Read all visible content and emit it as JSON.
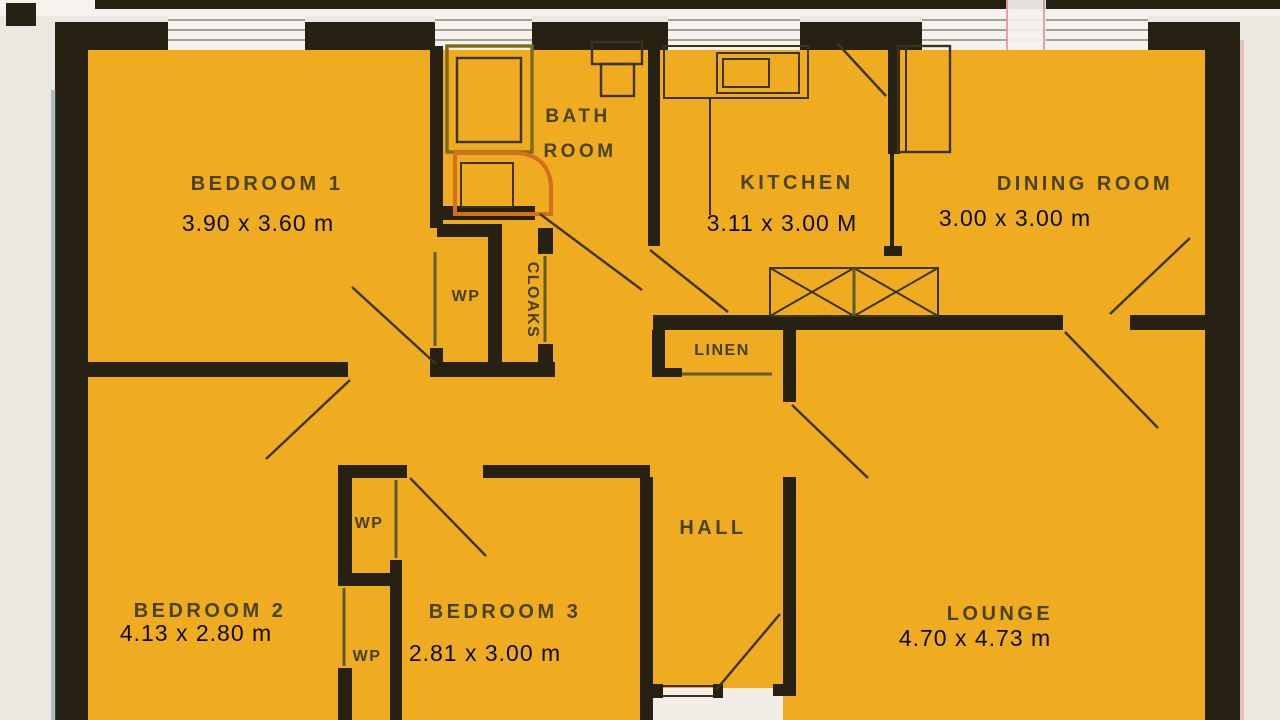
{
  "document_type": "scanned-floor-plan",
  "colors": {
    "page": "#ebe7e1",
    "page_top": "#f6f3ef",
    "floor": "#efac20",
    "wall": "#262113",
    "label": "#3e3a1b",
    "dims": "#0c0c0e",
    "window": "#f6f3ee",
    "window_line": "#8a8378",
    "fixture": "#3c3418",
    "tub_outline": "#7c6c14",
    "basin_orange": "#d2701e",
    "swing": "#3a3520",
    "door_line": "#5d5c26",
    "porch": "#f2eee7"
  },
  "rooms": {
    "bedroom1": {
      "label": "BEDROOM 1",
      "dims": "3.90 x 3.60 m"
    },
    "bathroom": {
      "label_line1": "BATH",
      "label_line2": "ROOM"
    },
    "kitchen": {
      "label": "KITCHEN",
      "dims": "3.11 x 3.00 M"
    },
    "dining_room": {
      "label": "DINING ROOM",
      "dims": "3.00 x 3.00 m"
    },
    "linen": {
      "label": "LINEN"
    },
    "hall": {
      "label": "HALL"
    },
    "bedroom2": {
      "label": "BEDROOM 2",
      "dims": "4.13 x 2.80 m"
    },
    "bedroom3": {
      "label": "BEDROOM 3",
      "dims": "2.81 x 3.00 m"
    },
    "lounge": {
      "label": "LOUNGE",
      "dims": "4.70 x 4.73 m"
    }
  },
  "closets": {
    "wp_hall": "WP",
    "cloaks": "CLOAKS",
    "wp_bedroom3": "WP",
    "wp_bedroom2": "WP"
  }
}
